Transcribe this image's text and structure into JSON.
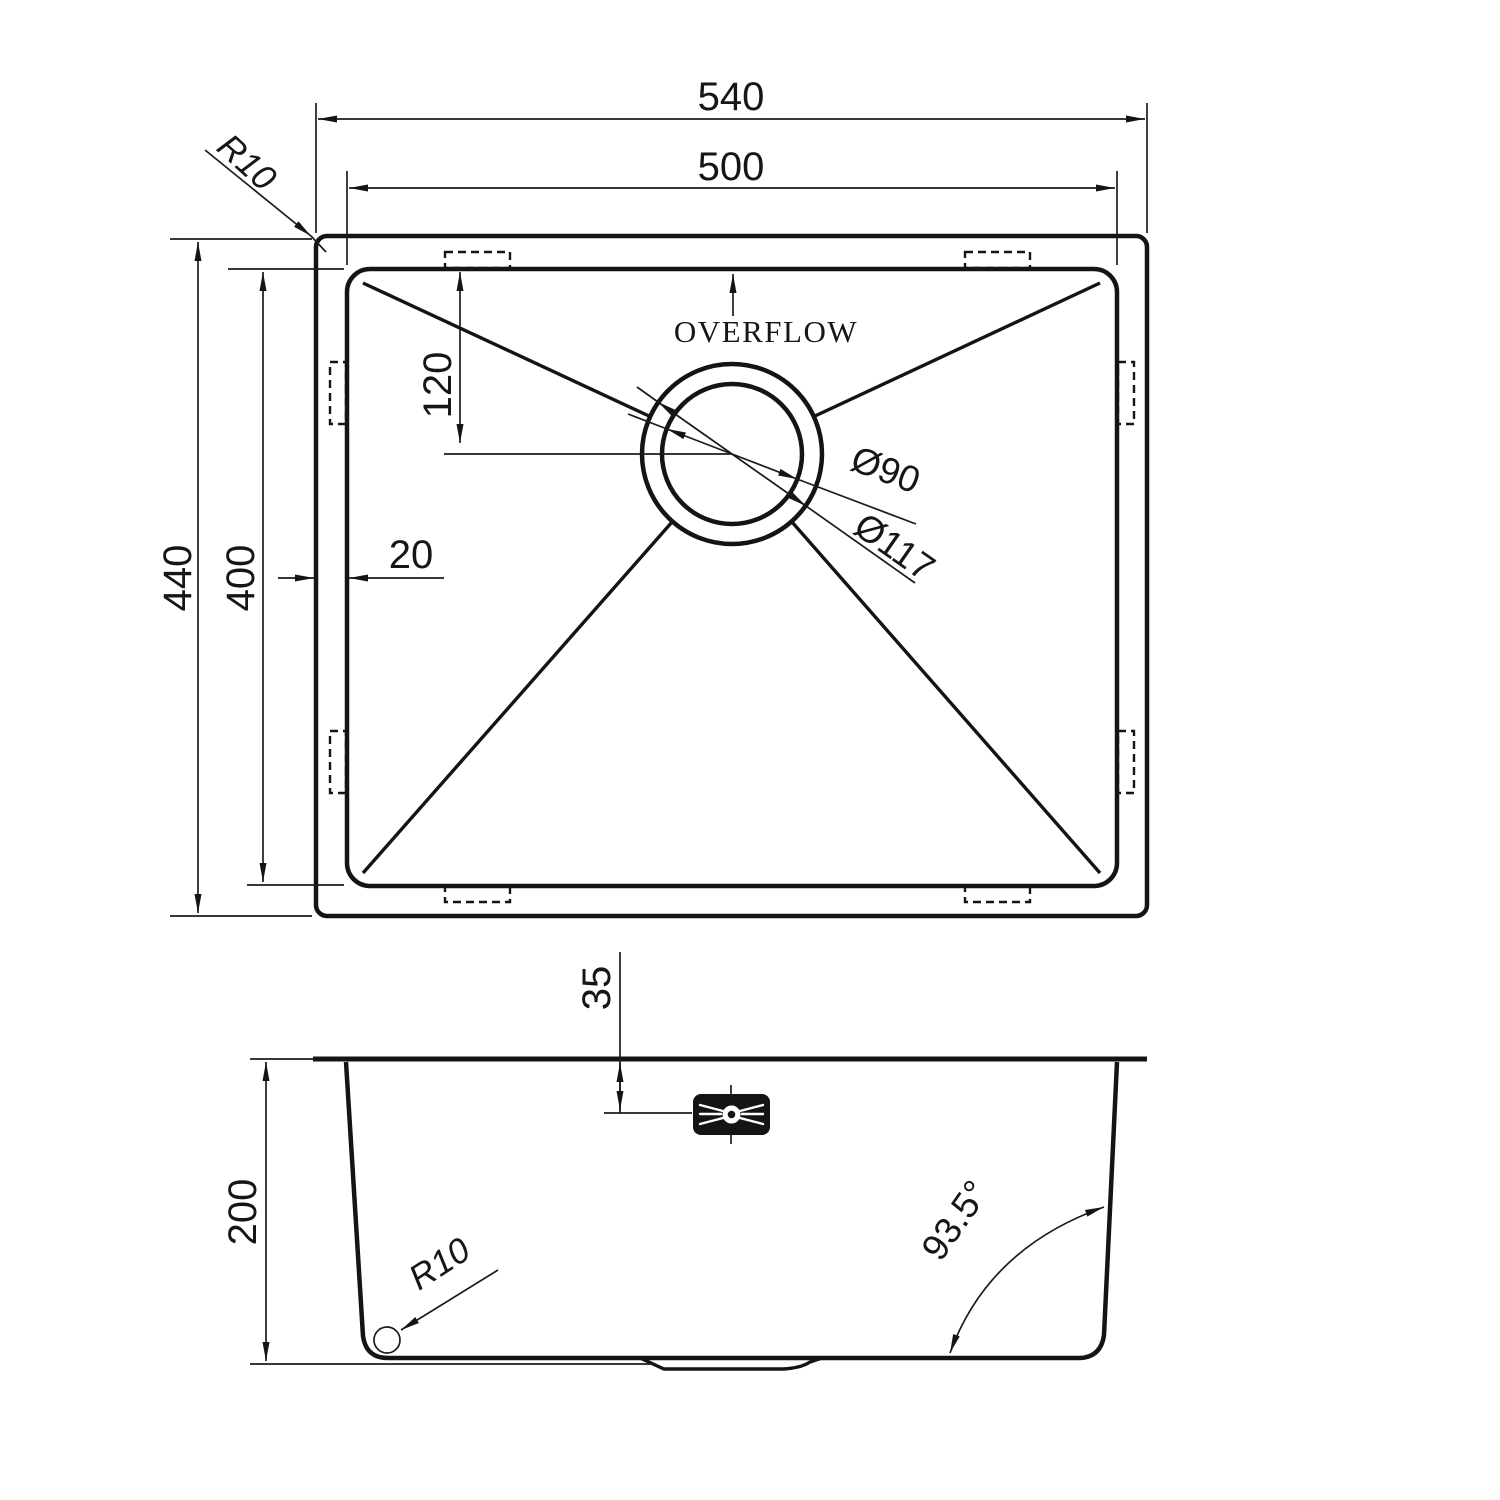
{
  "drawing": {
    "colors": {
      "line": "#141414",
      "background": "#ffffff"
    },
    "top_view": {
      "overall_width": "540",
      "bowl_width": "500",
      "overall_depth": "440",
      "bowl_depth": "400",
      "drain_center_from_top": "120",
      "flange_width": "20",
      "corner_radius_label": "R10",
      "overflow_label": "OVERFLOW",
      "drain_inner_diameter": "Ø90",
      "drain_outer_diameter": "Ø117"
    },
    "side_view": {
      "bowl_height": "200",
      "overflow_offset": "35",
      "bottom_radius_label": "R10",
      "wall_angle": "93.5°"
    }
  }
}
